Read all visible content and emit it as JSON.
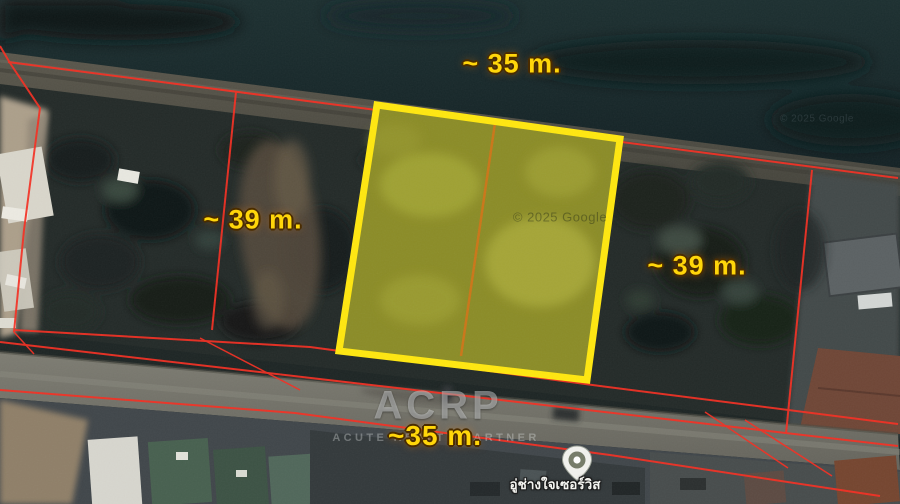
{
  "labels": {
    "top": "~ 35 m.",
    "left": "~ 39 m.",
    "right": "~ 39 m.",
    "bottom": "~35 m."
  },
  "branding": {
    "logo": "ACRP",
    "tagline": "ACUTE REALTY PARTNER"
  },
  "credits": {
    "center": "© 2025 Google",
    "top_right": "© 2025 Google"
  },
  "poi": {
    "name": "อู่ช่างใจเซอร์วิส"
  },
  "colors": {
    "boundary_red": "#f52f22",
    "plot_yellow_border": "#ffe70f",
    "plot_divider_orange": "#cf7518",
    "dimension_label_yellow": "#ffd60a"
  }
}
